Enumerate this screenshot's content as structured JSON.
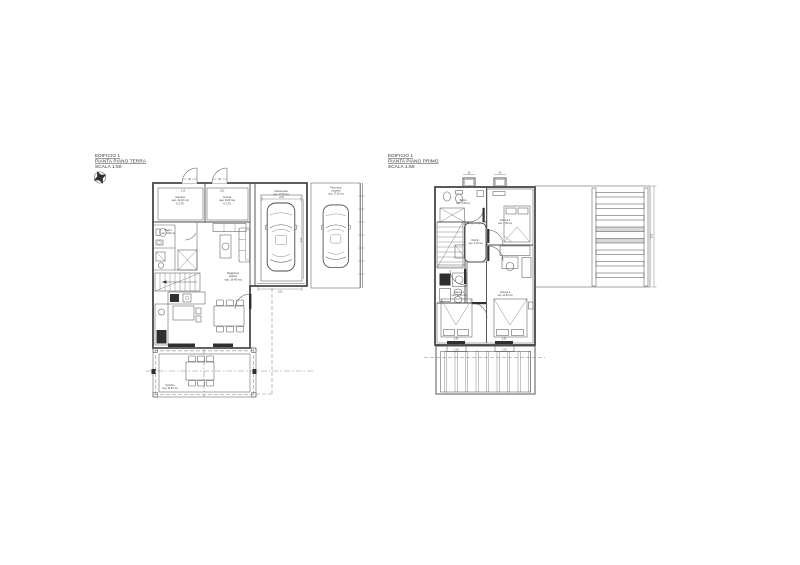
{
  "colors": {
    "line": "#474747",
    "cyan_room_fill": "#aedbe6",
    "green_room_fill": "#cde9c8",
    "paving_gray": "#9a9a9a",
    "slat_gray": "#d8d8d8"
  },
  "icons": {
    "compass": "north-arrow"
  },
  "ground_floor": {
    "header": [
      "EDIFICIO 1",
      "PIANTA PIANO TERRA",
      "SCALA 1:50"
    ],
    "labels": {
      "camera": [
        "Camera",
        "sup. 11,10 mq",
        "h 2,70"
      ],
      "cucina": [
        "Cucina",
        "sup. 9,20 mq",
        "h 2,70"
      ],
      "bagno": [
        "Bagno",
        "sup. 3,90 mq"
      ],
      "soggiorno": [
        "Soggiorno",
        "pranzo",
        "sup. 26,40 mq"
      ],
      "autorimessa": [
        "Autorimessa",
        "sup. 17,30 mq"
      ],
      "posto_auto": [
        "Posto auto",
        "scoperto",
        "sup. 17,00 mq"
      ],
      "terrazzo": [
        "Terrazzo",
        "sup. 16,50 mq"
      ]
    },
    "dims": {
      "door1": "90",
      "door2": "90",
      "room1_w": "1,15",
      "room2_w": "1,52",
      "garage_w": "2,50",
      "garage_d": "5,00",
      "garage_door": "2,50"
    }
  },
  "first_floor": {
    "header": [
      "EDIFICIO 1",
      "PIANTA PIANO PRIMO",
      "SCALA 1:50"
    ],
    "labels": {
      "bagno1": [
        "Bagno",
        "sup. 4,40 mq"
      ],
      "camera3": [
        "Camera 3",
        "sup. 7,50 mq"
      ],
      "disimpegno": [
        "Disimp.",
        "sup. 3,20 mq"
      ],
      "camera1": [
        "Camera 1",
        "sup. 11,60 mq"
      ],
      "camera2": [
        "Camera 2",
        "sup. 11,80 mq"
      ]
    },
    "dims": {
      "vent1": "60",
      "vent2": "60",
      "balcony_door1": "1,20",
      "balcony_door2": "1,20",
      "room1_w": "2,96",
      "room2_w": "2,96",
      "terrace_depth": "5,05"
    }
  }
}
